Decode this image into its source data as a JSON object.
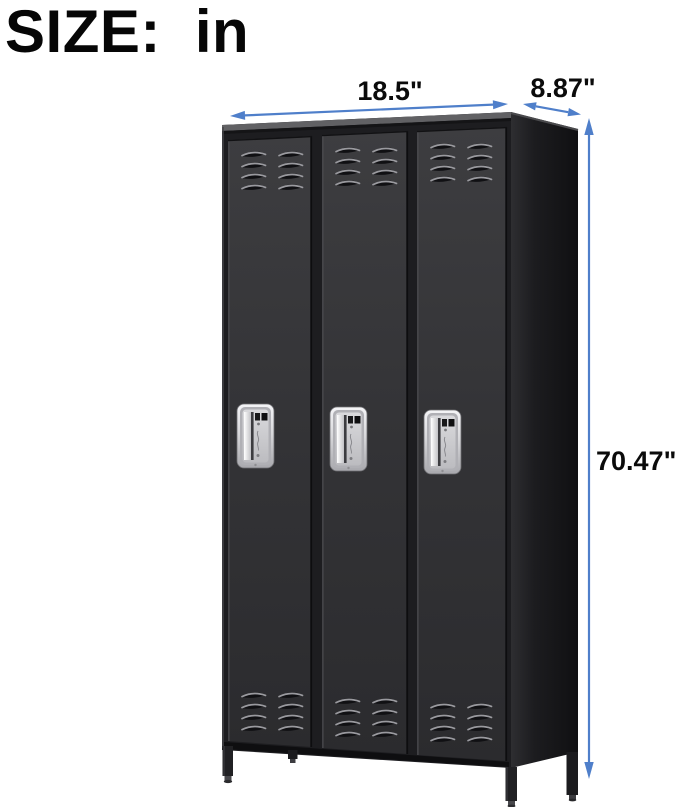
{
  "header": {
    "size_prefix": "SIZE:",
    "size_unit": "in"
  },
  "dimensions": {
    "width": "18.5\"",
    "depth": "8.87\"",
    "height": "70.47\""
  },
  "colors": {
    "arrow_blue": "#4f7fca",
    "label_black": "#0b0b0b",
    "locker_door": "#343437",
    "locker_side": "#131315",
    "handle_chrome": "#d9d9dc"
  },
  "illustration": {
    "name": "three-door-metal-locker-on-legs"
  }
}
